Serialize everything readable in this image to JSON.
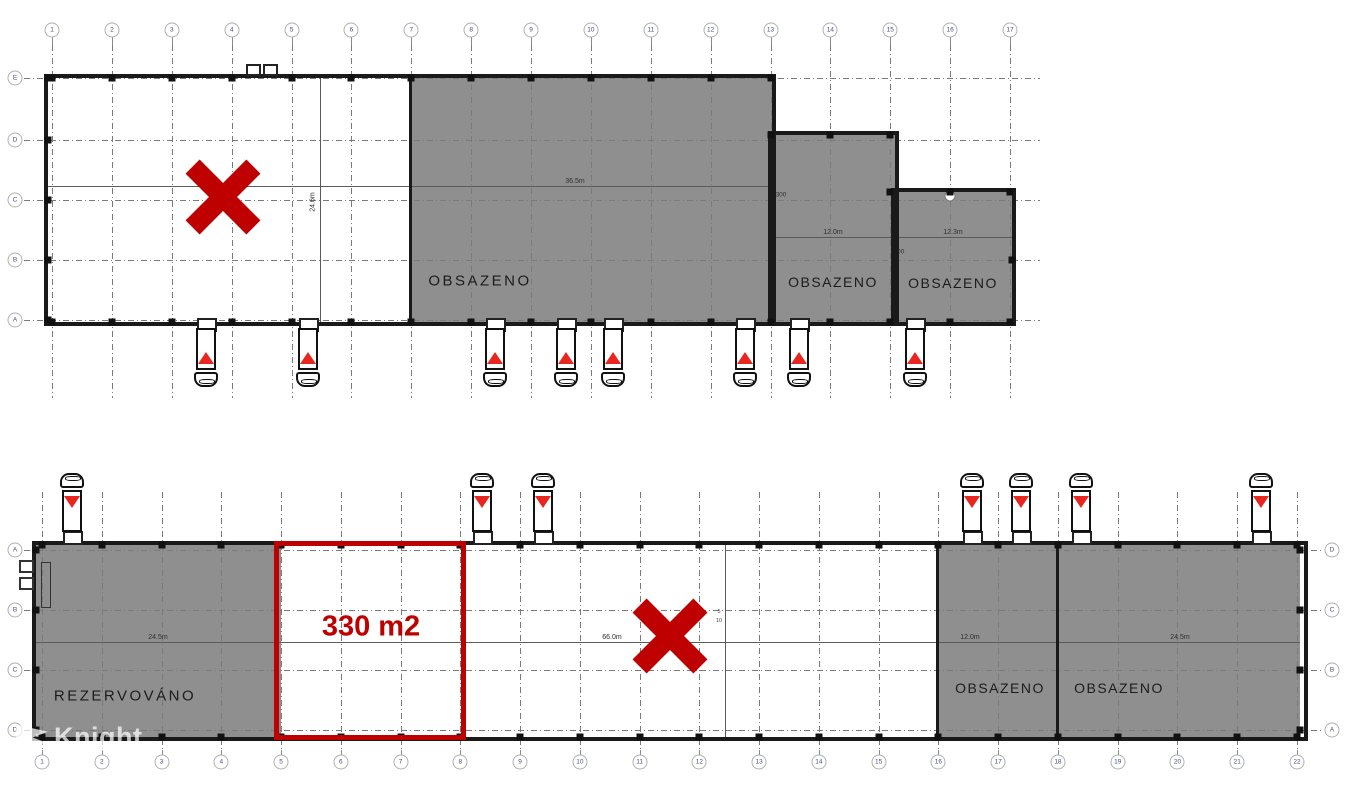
{
  "watermark": {
    "brand_text": "Knight"
  },
  "colors": {
    "occupied_fill": "#8F8F8F",
    "available_outline": "#BF0000",
    "cross_red": "#BF0000",
    "truck_arrow_red": "#E8251F",
    "wall": "#1A1A1A"
  },
  "top_plan": {
    "column_axis_labels": [
      "1",
      "2",
      "3",
      "4",
      "5",
      "6",
      "7",
      "8",
      "9",
      "10",
      "11",
      "12",
      "13",
      "14",
      "15",
      "16",
      "17"
    ],
    "row_axis_labels": [
      "E",
      "D",
      "C",
      "B",
      "A"
    ],
    "units": [
      {
        "id": "unit-1-7",
        "label": "",
        "status": "crossed-out"
      },
      {
        "id": "unit-7-13",
        "label": "OBSAZENO",
        "status": "occupied"
      },
      {
        "id": "unit-13-15",
        "label": "OBSAZENO",
        "status": "occupied"
      },
      {
        "id": "unit-15-17",
        "label": "OBSAZENO",
        "status": "occupied"
      }
    ],
    "dimensions": {
      "main_width": "36.5m",
      "depth": "24.6m",
      "unit_13_15_width": "12.0m",
      "unit_15_17_width": "12.3m",
      "note_a": "300",
      "note_b": "300"
    }
  },
  "bottom_plan": {
    "column_axis_labels": [
      "1",
      "2",
      "3",
      "4",
      "5",
      "6",
      "7",
      "8",
      "9",
      "10",
      "11",
      "12",
      "13",
      "14",
      "15",
      "16",
      "17",
      "18",
      "19",
      "20",
      "21",
      "22"
    ],
    "row_axis_labels_left": [
      "A",
      "B",
      "C",
      "D"
    ],
    "row_axis_labels_right": [
      "D",
      "C",
      "B",
      "A"
    ],
    "units": [
      {
        "id": "unit-1-5",
        "label": "REZERVOVÁNO",
        "status": "reserved"
      },
      {
        "id": "unit-5-8",
        "label": "330 m2",
        "status": "available"
      },
      {
        "id": "unit-8-16",
        "label": "",
        "status": "crossed-out"
      },
      {
        "id": "unit-16-18",
        "label": "OBSAZENO",
        "status": "occupied"
      },
      {
        "id": "unit-18-22",
        "label": "OBSAZENO",
        "status": "occupied"
      }
    ],
    "dimensions": {
      "left_width": "24.5m",
      "middle_width": "66.0m",
      "right1_width": "12.0m",
      "right2_width": "24.5m",
      "vertical_note_top": "5",
      "vertical_note_bottom": "10"
    }
  }
}
